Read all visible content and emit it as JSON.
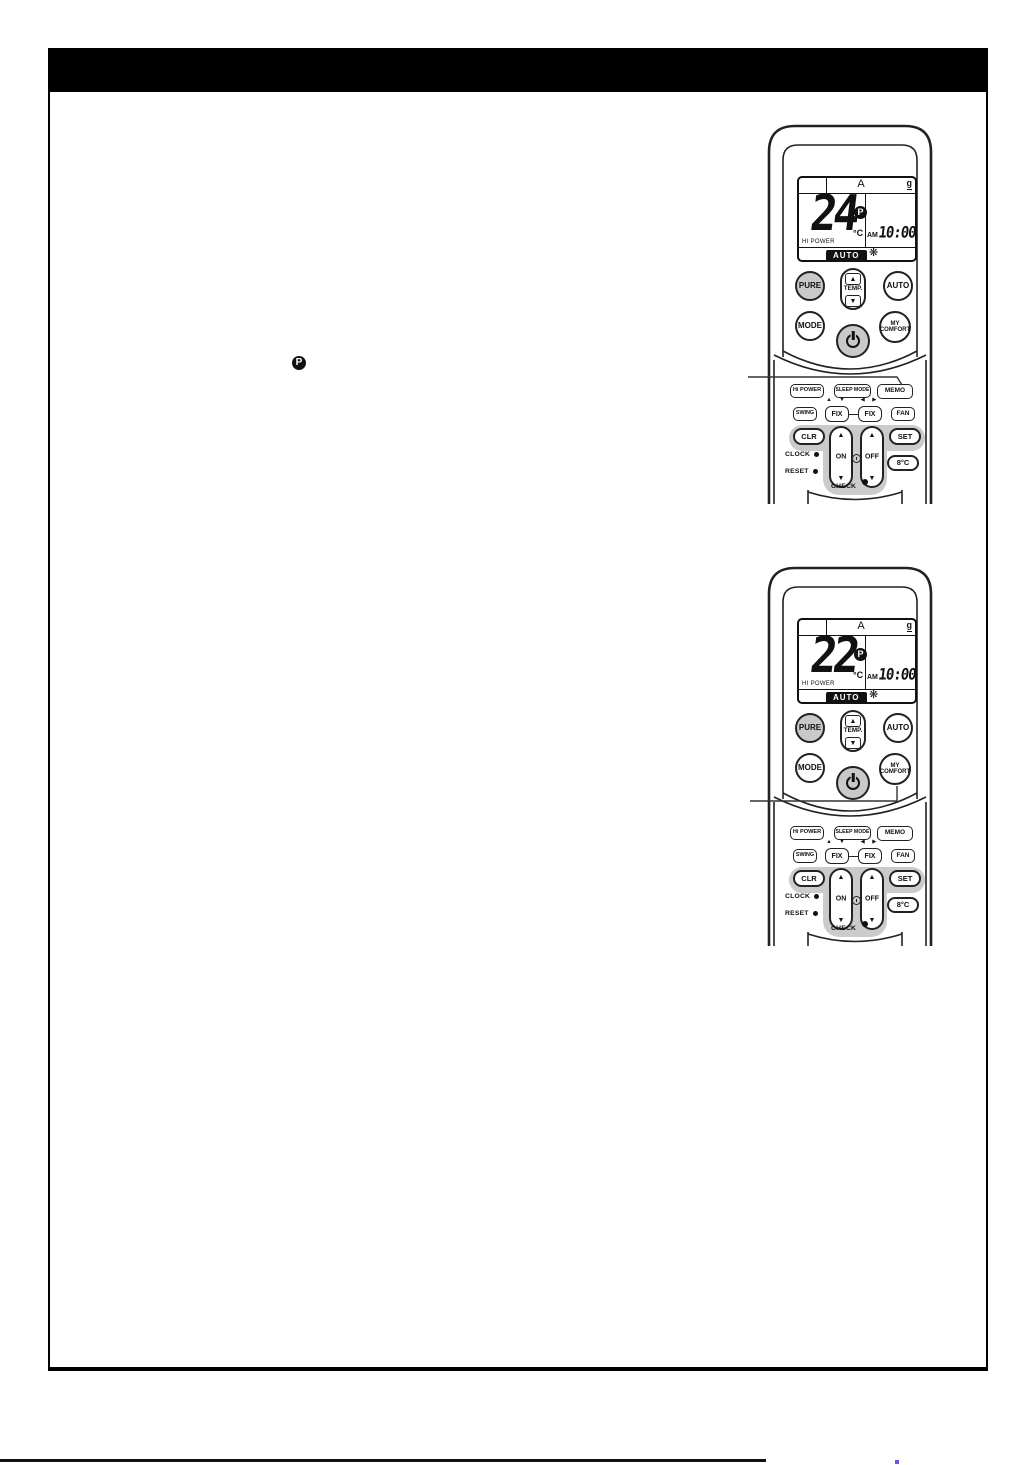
{
  "inline": {
    "preset_symbol": "P"
  },
  "display": {
    "unit": "A",
    "signal": "g",
    "degrees": "°C",
    "hi_power": "HI POWER",
    "am": "AM",
    "time": "10:00",
    "mode_badge": "AUTO",
    "fan": "❋",
    "preset": "P"
  },
  "buttons": {
    "pure": "PURE",
    "temp": "TEMP.",
    "up": "▲",
    "down": "▼",
    "auto": "AUTO",
    "mode": "MODE",
    "my1": "MY",
    "my2": "COMFORT",
    "hi_power": "Hi POWER",
    "sleep_mode": "SLEEP MODE",
    "memo": "MEMO",
    "swing": "SWING",
    "fix": "FIX",
    "fan": "FAN",
    "ud_arrows": "▲ ▼",
    "lr_arrows": "◀ ▶",
    "clr": "CLR",
    "set": "SET",
    "on": "ON",
    "off": "OFF",
    "eight_c": "8°C",
    "clock": "CLOCK",
    "reset": "RESET",
    "check": "CHECK"
  },
  "remotes": [
    {
      "temp": "24"
    },
    {
      "temp": "22"
    }
  ]
}
